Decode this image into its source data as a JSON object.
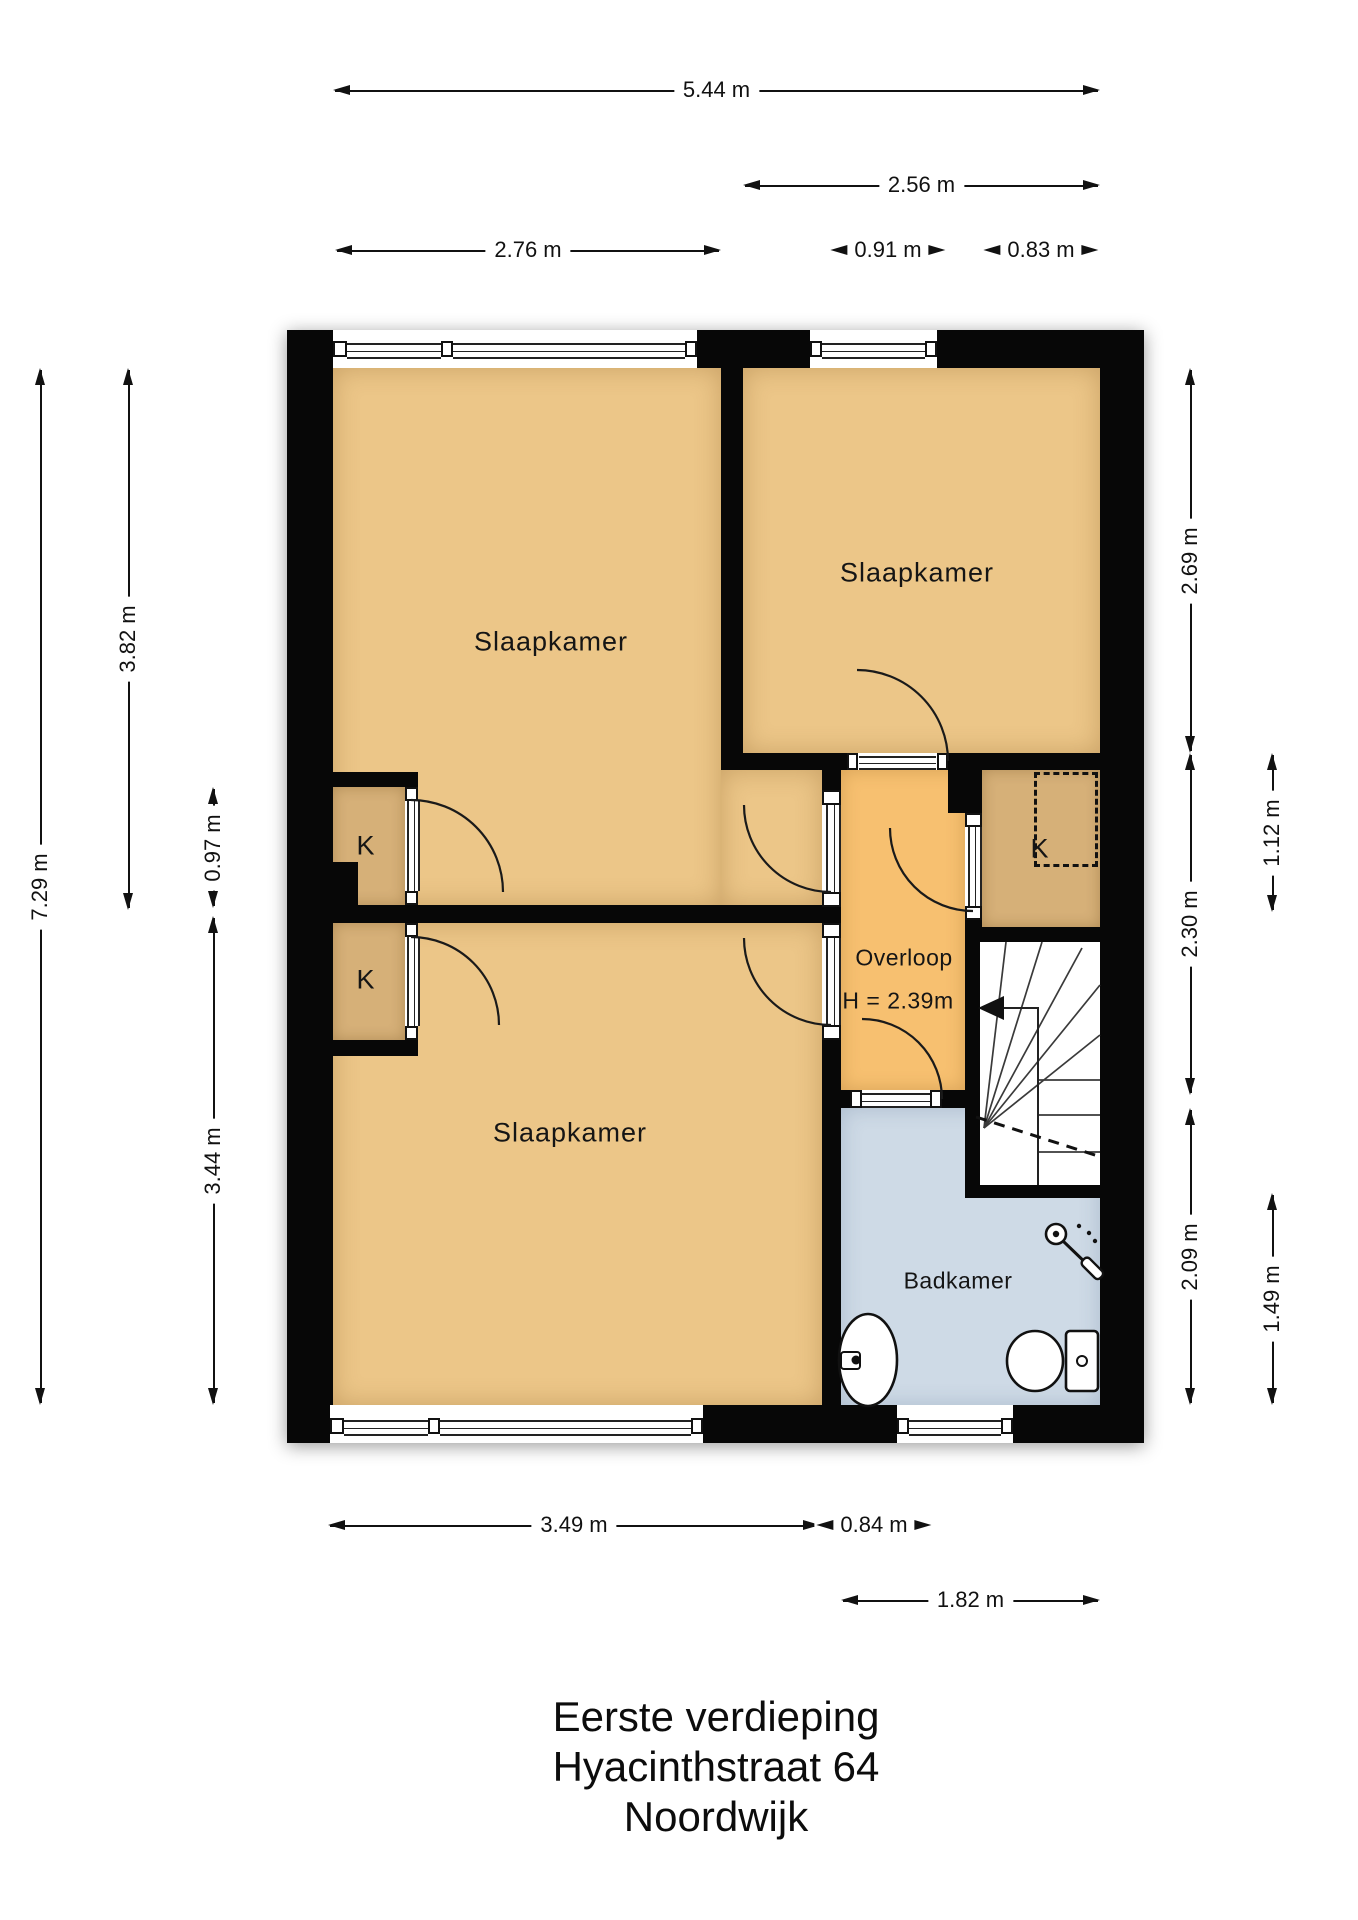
{
  "title": {
    "line1": "Eerste verdieping",
    "line2": "Hyacinthstraat 64",
    "line3": "Noordwijk"
  },
  "rooms": {
    "bedroom_top_left": {
      "label": "Slaapkamer"
    },
    "bedroom_top_right": {
      "label": "Slaapkamer"
    },
    "bedroom_bottom_left": {
      "label": "Slaapkamer"
    },
    "hallway": {
      "label": "Overloop",
      "height_note": "H = 2.39m"
    },
    "bathroom": {
      "label": "Badkamer"
    },
    "closet_left_top": {
      "label": "K"
    },
    "closet_left_bottom": {
      "label": "K"
    },
    "closet_right": {
      "label": "K"
    }
  },
  "dimensions": {
    "top": {
      "d544": "5.44 m",
      "d256": "2.56 m",
      "d276": "2.76 m",
      "d091": "0.91 m",
      "d083": "0.83 m"
    },
    "left": {
      "d729": "7.29 m",
      "d382": "3.82 m",
      "d097": "0.97 m",
      "d344": "3.44 m"
    },
    "right": {
      "d269": "2.69 m",
      "d112": "1.12 m",
      "d230": "2.30 m",
      "d209": "2.09 m",
      "d149": "1.49 m"
    },
    "bottom": {
      "d349": "3.49 m",
      "d084": "0.84 m",
      "d182": "1.82 m"
    }
  },
  "colors": {
    "wall": "#070707",
    "bedroom": "#ecc688",
    "closet": "#d6b078",
    "hallway": "#f7c070",
    "bathroom": "#cedae6",
    "stairs": "#ffffff",
    "background": "#ffffff"
  }
}
